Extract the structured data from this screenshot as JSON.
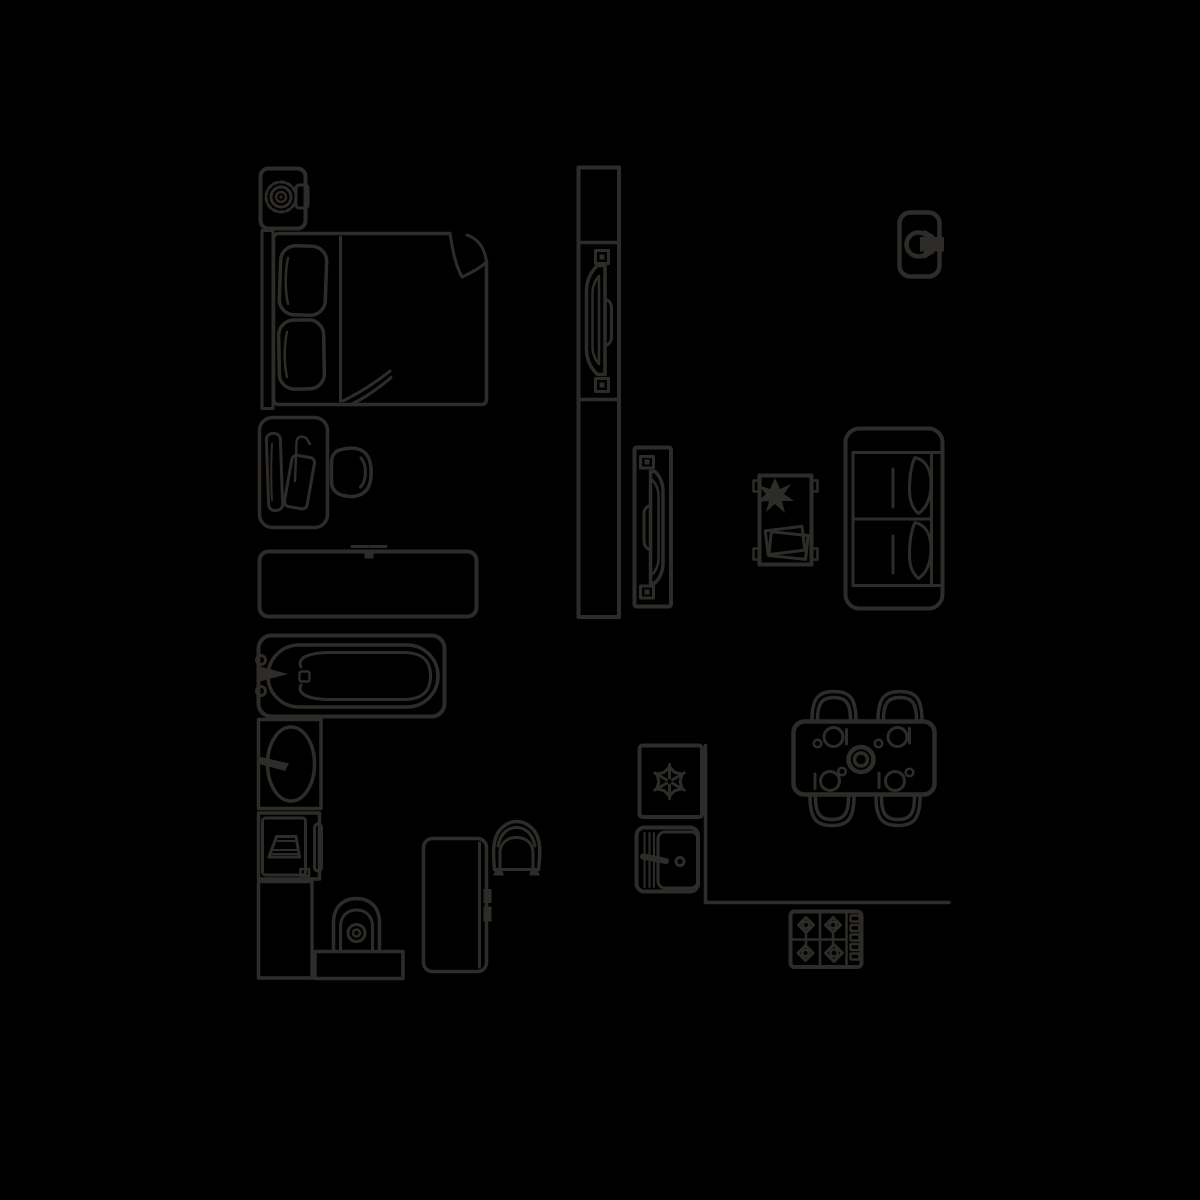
{
  "scene": {
    "title": "apartment-floor-plan-furniture-symbols",
    "background_color": "#000000",
    "line_color": "#2e2c28"
  },
  "items": {
    "washing_machine": "washing machine with round drum and detergent drawer",
    "bed": "double bed with headboard, two pillows, seam line and folded blanket corner",
    "vanity_desk": "dressing table with lamp and papers",
    "vanity_chair": "tub chair at dressing table",
    "dresser": "low dresser / TV cabinet with mount marks",
    "bathtub": "bathtub with rim, drain and two-tap faucet",
    "sink": "wash basin with tap",
    "laundry_unit": "compact laundry appliance with basket and side door",
    "cabinet": "bathroom cabinet",
    "toilet": "toilet with cistern and bowl",
    "work_desk": "desk with two drawer handles",
    "desk_chair": "tub chair at desk",
    "door_large": "large pocket door plan symbol with hinges and handle",
    "door_small": "small pocket door plan symbol with hinges and handle",
    "wall_unit": "wall appliance with circular rotation arrow",
    "sofa": "two-seat sofa with armrests, seat marks and back cushions",
    "coffee_table": "coffee table with potted plant and magazines",
    "dining_set": "dining table for four with plates, glasses, cutlery and centre bowl",
    "counter": "kitchen counter outline",
    "fridge": "freezer with snowflake symbol",
    "oven": "oven with handle bar and control knob",
    "hob": "gas hob with four burners and knob strip"
  }
}
